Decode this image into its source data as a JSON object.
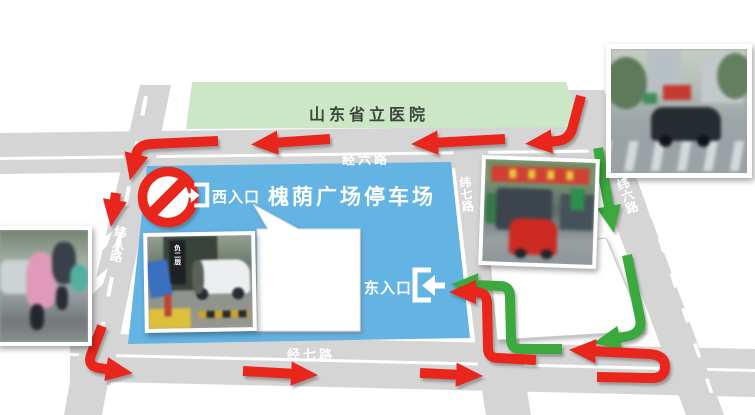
{
  "canvas": {
    "width": 755,
    "height": 415,
    "background": "#ffffff"
  },
  "colors": {
    "road": "#d5d5d5",
    "red": "#e8261d",
    "green": "#3aa93c",
    "hospital_fill": "#cbe7c6",
    "parking_fill": "#63b3e3",
    "building_fill": "#ffffff"
  },
  "hospital": {
    "label": "山东省立医院"
  },
  "parking": {
    "title": "槐荫广场停车场",
    "west_entrance": "西入口",
    "east_entrance": "东入口"
  },
  "roads": {
    "jing6": "经六路",
    "jing7": "经七路",
    "wei6": "纬六路",
    "wei7": "纬七路",
    "wei8": "纬八路"
  },
  "signs": {
    "no_entry": "no-entry-prohibition-sign"
  },
  "photos": {
    "west": "scooter-riders-in-rain-ponchos-street-photo",
    "parking": "underground-garage-entrance-with-white-car-photo",
    "parking_sign": "负二层",
    "east": "market-street-with-red-car-and-buses-photo",
    "topright": "rainy-crossroad-with-dark-car-photo"
  }
}
